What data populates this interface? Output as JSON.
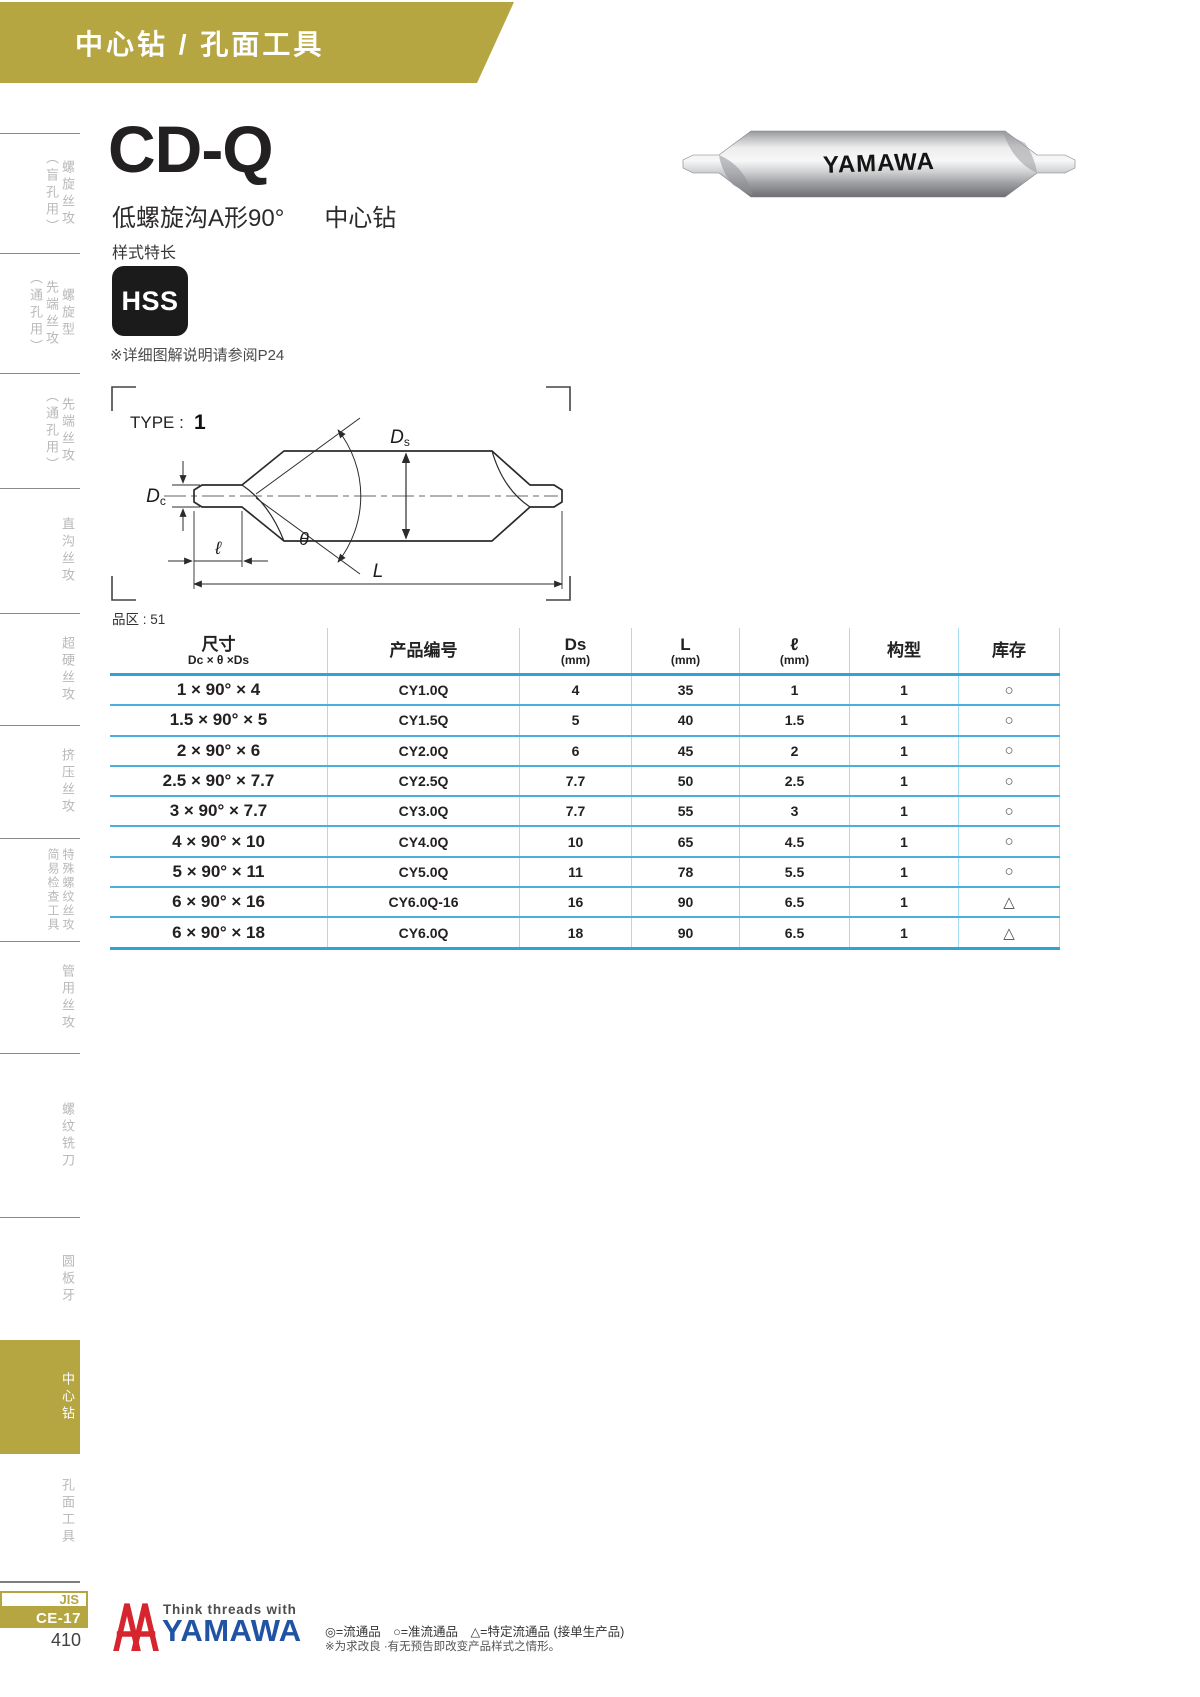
{
  "header": {
    "title": "中心钻 / 孔面工具"
  },
  "sidebar": {
    "items": [
      {
        "cols": [
          "螺旋丝攻",
          "（盲孔用）"
        ],
        "active": false
      },
      {
        "cols": [
          "螺旋型",
          "先端丝攻",
          "（通孔用）"
        ],
        "active": false
      },
      {
        "cols": [
          "先端丝攻",
          "（通孔用）"
        ],
        "active": false
      },
      {
        "cols": [
          "直沟丝攻"
        ],
        "active": false
      },
      {
        "cols": [
          "超硬丝攻"
        ],
        "active": false
      },
      {
        "cols": [
          "挤压丝攻"
        ],
        "active": false
      },
      {
        "cols": [
          "特殊螺纹丝攻",
          "简易检查工具"
        ],
        "active": false
      },
      {
        "cols": [
          "管用丝攻"
        ],
        "active": false
      },
      {
        "cols": [
          "螺纹铣刀"
        ],
        "active": false
      },
      {
        "cols": [
          "圆板牙"
        ],
        "active": false
      },
      {
        "cols": [
          "中心钻"
        ],
        "active": true
      },
      {
        "cols": [
          "孔面工具"
        ],
        "active": false
      }
    ],
    "jis_label": "JIS",
    "ce_label": "CE-17",
    "page_number": "410"
  },
  "product": {
    "model": "CD-Q",
    "series_cn": "低螺旋沟A形90°",
    "series_tail": "中心钻",
    "feature": "样式特长",
    "material": "HSS",
    "note": "※详细图解说明请参阅P24",
    "photo_brand": "YAMAWA"
  },
  "diagram": {
    "type_label": "TYPE :",
    "type_value": "1",
    "labels": {
      "ds": "Ds",
      "dc": "Dc",
      "pilot_len": "ℓ",
      "angle": "θ",
      "overall_len": "L"
    }
  },
  "table": {
    "block_label": "品区 : 51",
    "columns": [
      {
        "title": "尺寸",
        "sub": "Dc × θ ×Ds"
      },
      {
        "title": "产品编号",
        "sub": ""
      },
      {
        "title": "Ds",
        "sub": "(mm)"
      },
      {
        "title": "L",
        "sub": "(mm)"
      },
      {
        "title": "ℓ",
        "sub": "(mm)"
      },
      {
        "title": "构型",
        "sub": ""
      },
      {
        "title": "库存",
        "sub": ""
      }
    ],
    "rows": [
      {
        "size": "1 × 90° × 4",
        "code": "CY1.0Q",
        "ds": "4",
        "l": "35",
        "ell": "1",
        "type": "1",
        "stock": "○"
      },
      {
        "size": "1.5 × 90° × 5",
        "code": "CY1.5Q",
        "ds": "5",
        "l": "40",
        "ell": "1.5",
        "type": "1",
        "stock": "○"
      },
      {
        "size": "2 × 90° × 6",
        "code": "CY2.0Q",
        "ds": "6",
        "l": "45",
        "ell": "2",
        "type": "1",
        "stock": "○"
      },
      {
        "size": "2.5 × 90° × 7.7",
        "code": "CY2.5Q",
        "ds": "7.7",
        "l": "50",
        "ell": "2.5",
        "type": "1",
        "stock": "○"
      },
      {
        "size": "3 × 90° × 7.7",
        "code": "CY3.0Q",
        "ds": "7.7",
        "l": "55",
        "ell": "3",
        "type": "1",
        "stock": "○"
      },
      {
        "size": "4 × 90° × 10",
        "code": "CY4.0Q",
        "ds": "10",
        "l": "65",
        "ell": "4.5",
        "type": "1",
        "stock": "○"
      },
      {
        "size": "5 × 90° × 11",
        "code": "CY5.0Q",
        "ds": "11",
        "l": "78",
        "ell": "5.5",
        "type": "1",
        "stock": "○"
      },
      {
        "size": "6 × 90° × 16",
        "code": "CY6.0Q-16",
        "ds": "16",
        "l": "90",
        "ell": "6.5",
        "type": "1",
        "stock": "△"
      },
      {
        "size": "6 × 90° × 18",
        "code": "CY6.0Q",
        "ds": "18",
        "l": "90",
        "ell": "6.5",
        "type": "1",
        "stock": "△"
      }
    ]
  },
  "footer": {
    "tagline": "Think threads with",
    "brand": "YAMAWA",
    "legend": "◎=流通品　○=准流通品　△=特定流通品 (接单生产品)",
    "disclaimer": "※为求改良 ·有无预告即改变产品样式之情形。"
  },
  "colors": {
    "accent_gold": "#b5a642",
    "table_line_strong": "#2fa3d8",
    "table_line": "#4aaede",
    "table_line_light": "#a5ddf4",
    "logo_red": "#d6252f",
    "logo_blue": "#2053a4"
  }
}
